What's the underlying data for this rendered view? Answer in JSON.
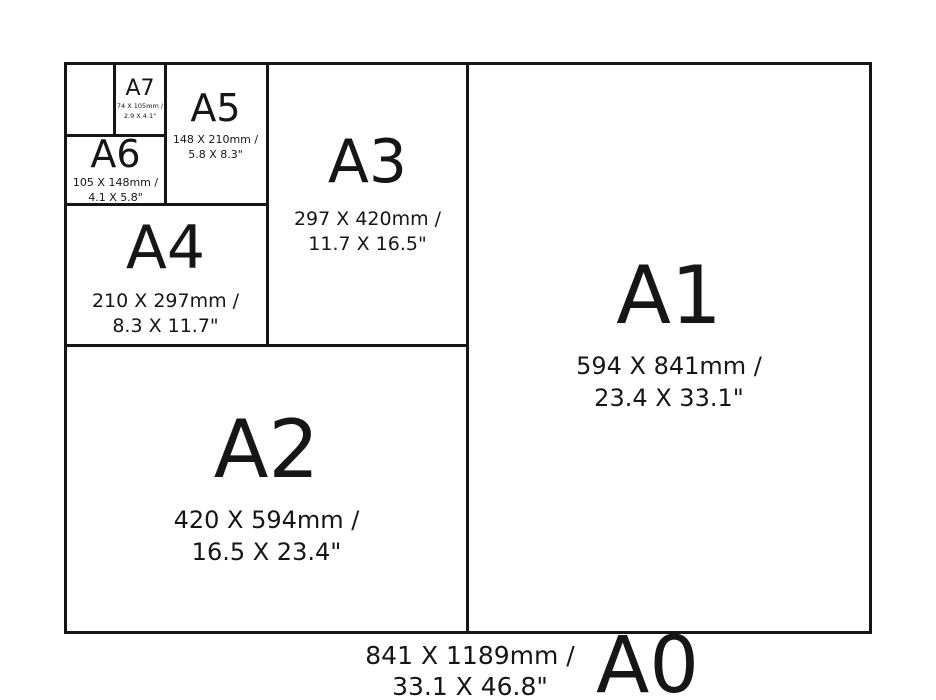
{
  "colors": {
    "background": "#ffffff",
    "line": "#161616",
    "text": "#161616"
  },
  "sizes": [
    {
      "id": "a7",
      "label": "A7",
      "dims_mm": "74 X 105mm /",
      "dims_in": "2.9 X 4.1\""
    },
    {
      "id": "a6",
      "label": "A6",
      "dims_mm": "105 X 148mm /",
      "dims_in": "4.1 X 5.8\""
    },
    {
      "id": "a5",
      "label": "A5",
      "dims_mm": "148 X 210mm /",
      "dims_in": "5.8 X 8.3\""
    },
    {
      "id": "a4",
      "label": "A4",
      "dims_mm": "210 X 297mm /",
      "dims_in": "8.3 X 11.7\""
    },
    {
      "id": "a3",
      "label": "A3",
      "dims_mm": "297 X 420mm /",
      "dims_in": "11.7 X 16.5\""
    },
    {
      "id": "a2",
      "label": "A2",
      "dims_mm": "420 X 594mm /",
      "dims_in": "16.5 X 23.4\""
    },
    {
      "id": "a1",
      "label": "A1",
      "dims_mm": "594 X 841mm /",
      "dims_in": "23.4 X 33.1\""
    },
    {
      "id": "a0",
      "label": "A0",
      "dims_mm": "841 X 1189mm /",
      "dims_in": "33.1 X 46.8\""
    }
  ]
}
